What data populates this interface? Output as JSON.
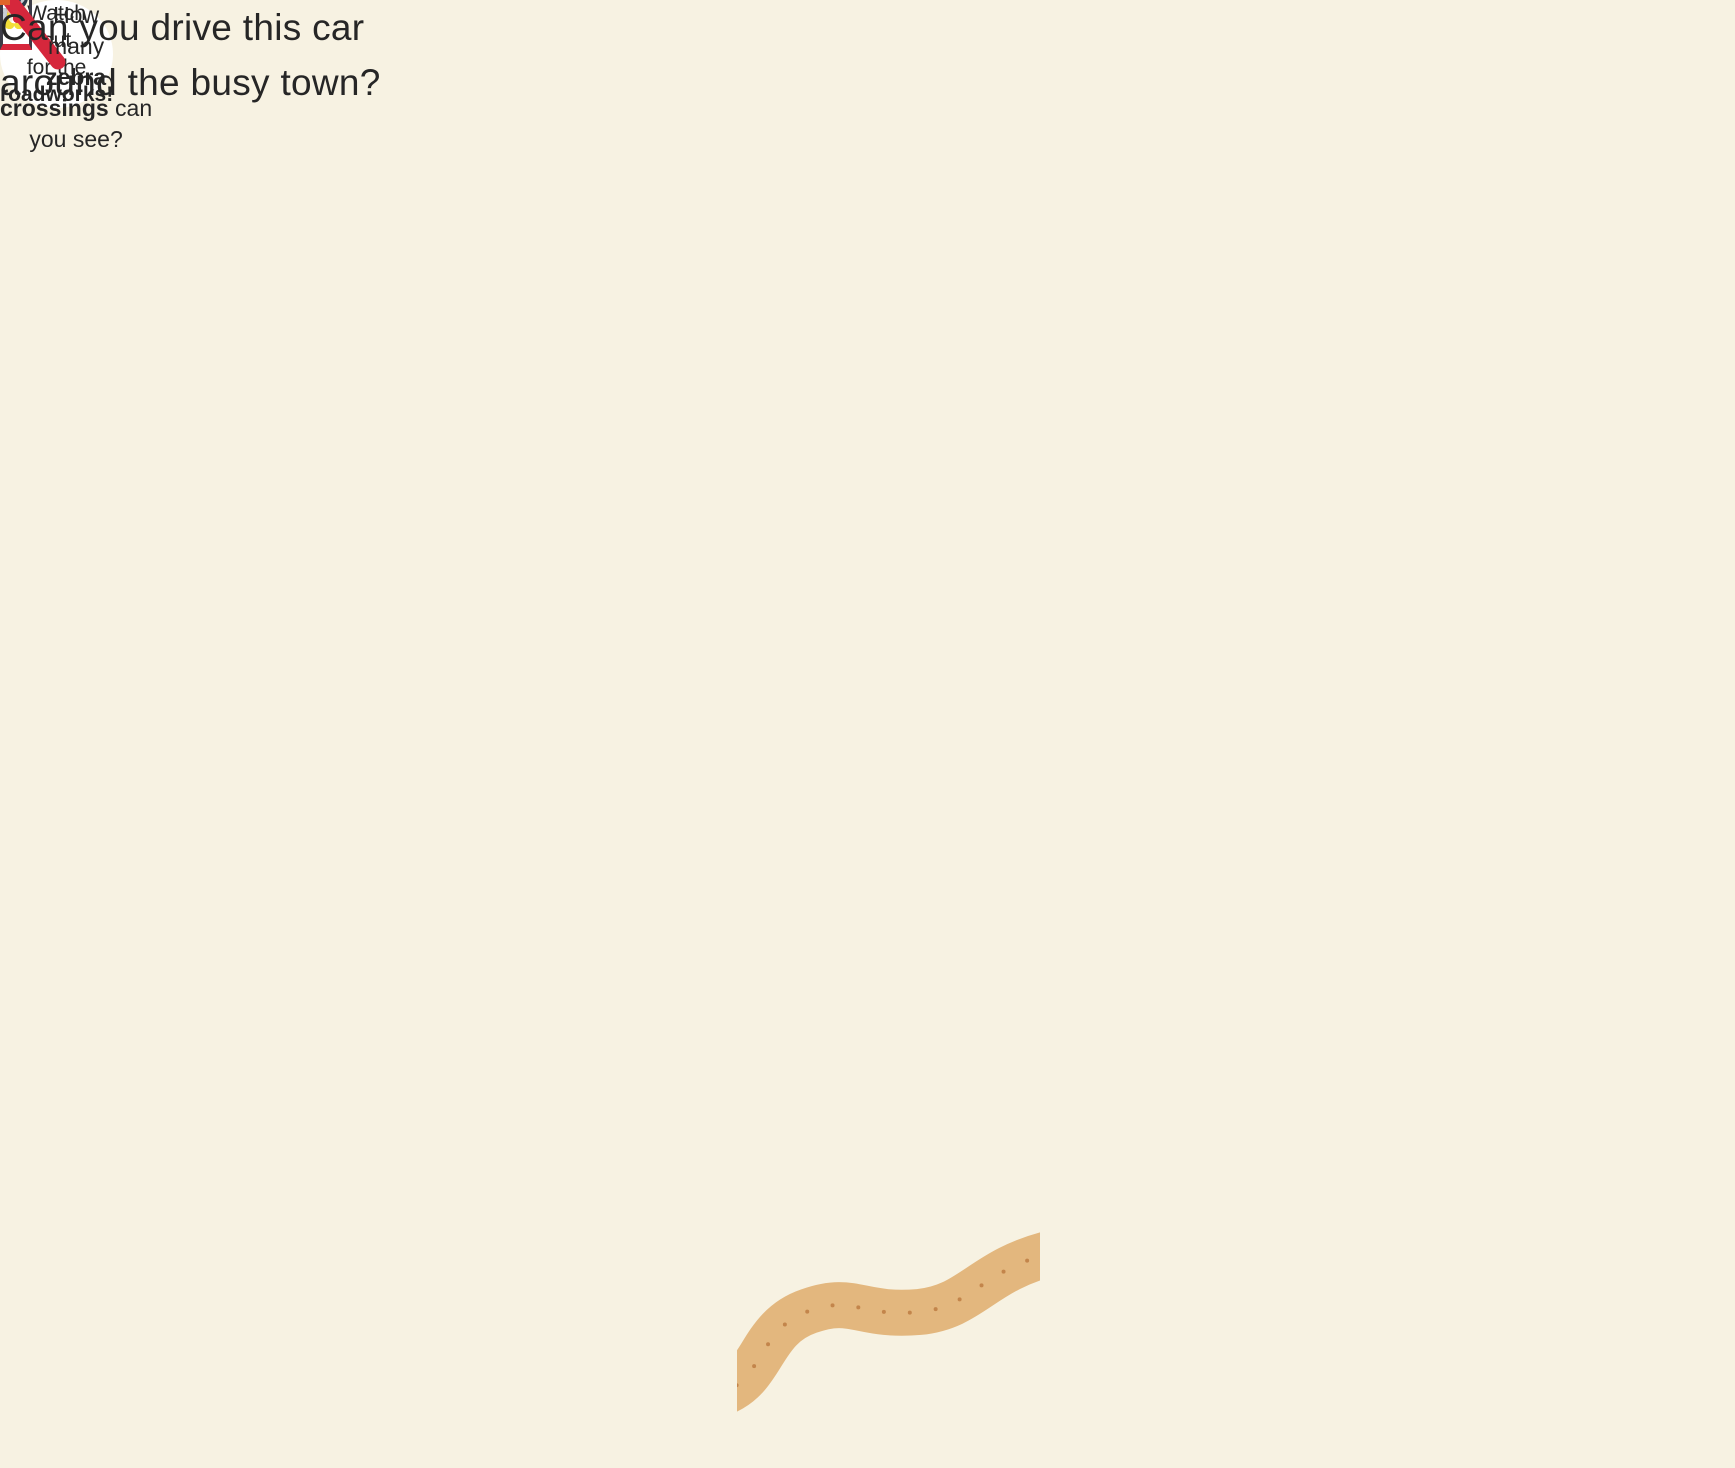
{
  "texts": {
    "heading": {
      "line1": "Can you drive this car",
      "line2": "around the busy town?"
    },
    "zebra_question": {
      "l1": "How",
      "l2": "many",
      "l3": "zebra",
      "l4_bold": "crossings",
      "l4_rest": " can",
      "l5": "you see?"
    },
    "bubble": {
      "l1": "Watch",
      "l2": "out",
      "l3": "for the",
      "l4": "roadworks!"
    }
  },
  "colors": {
    "background": "#f7f2e2",
    "road": "#66778b",
    "park_green": "#bdb93f",
    "sand": "#eabd80",
    "building_red": "#e8432f",
    "building_yellow": "#f7ea35",
    "building_orange": "#f3b03c",
    "building_teal": "#92c7b6",
    "building_olive": "#6f7c2c",
    "window_teal": "#b9e1dd",
    "roof_dark": "#45454f",
    "roof_purple": "#4c4254",
    "door_orange": "#f2672c",
    "door_yellow": "#f7e93c",
    "barrier_red": "#e8402f",
    "text": "#262626"
  }
}
